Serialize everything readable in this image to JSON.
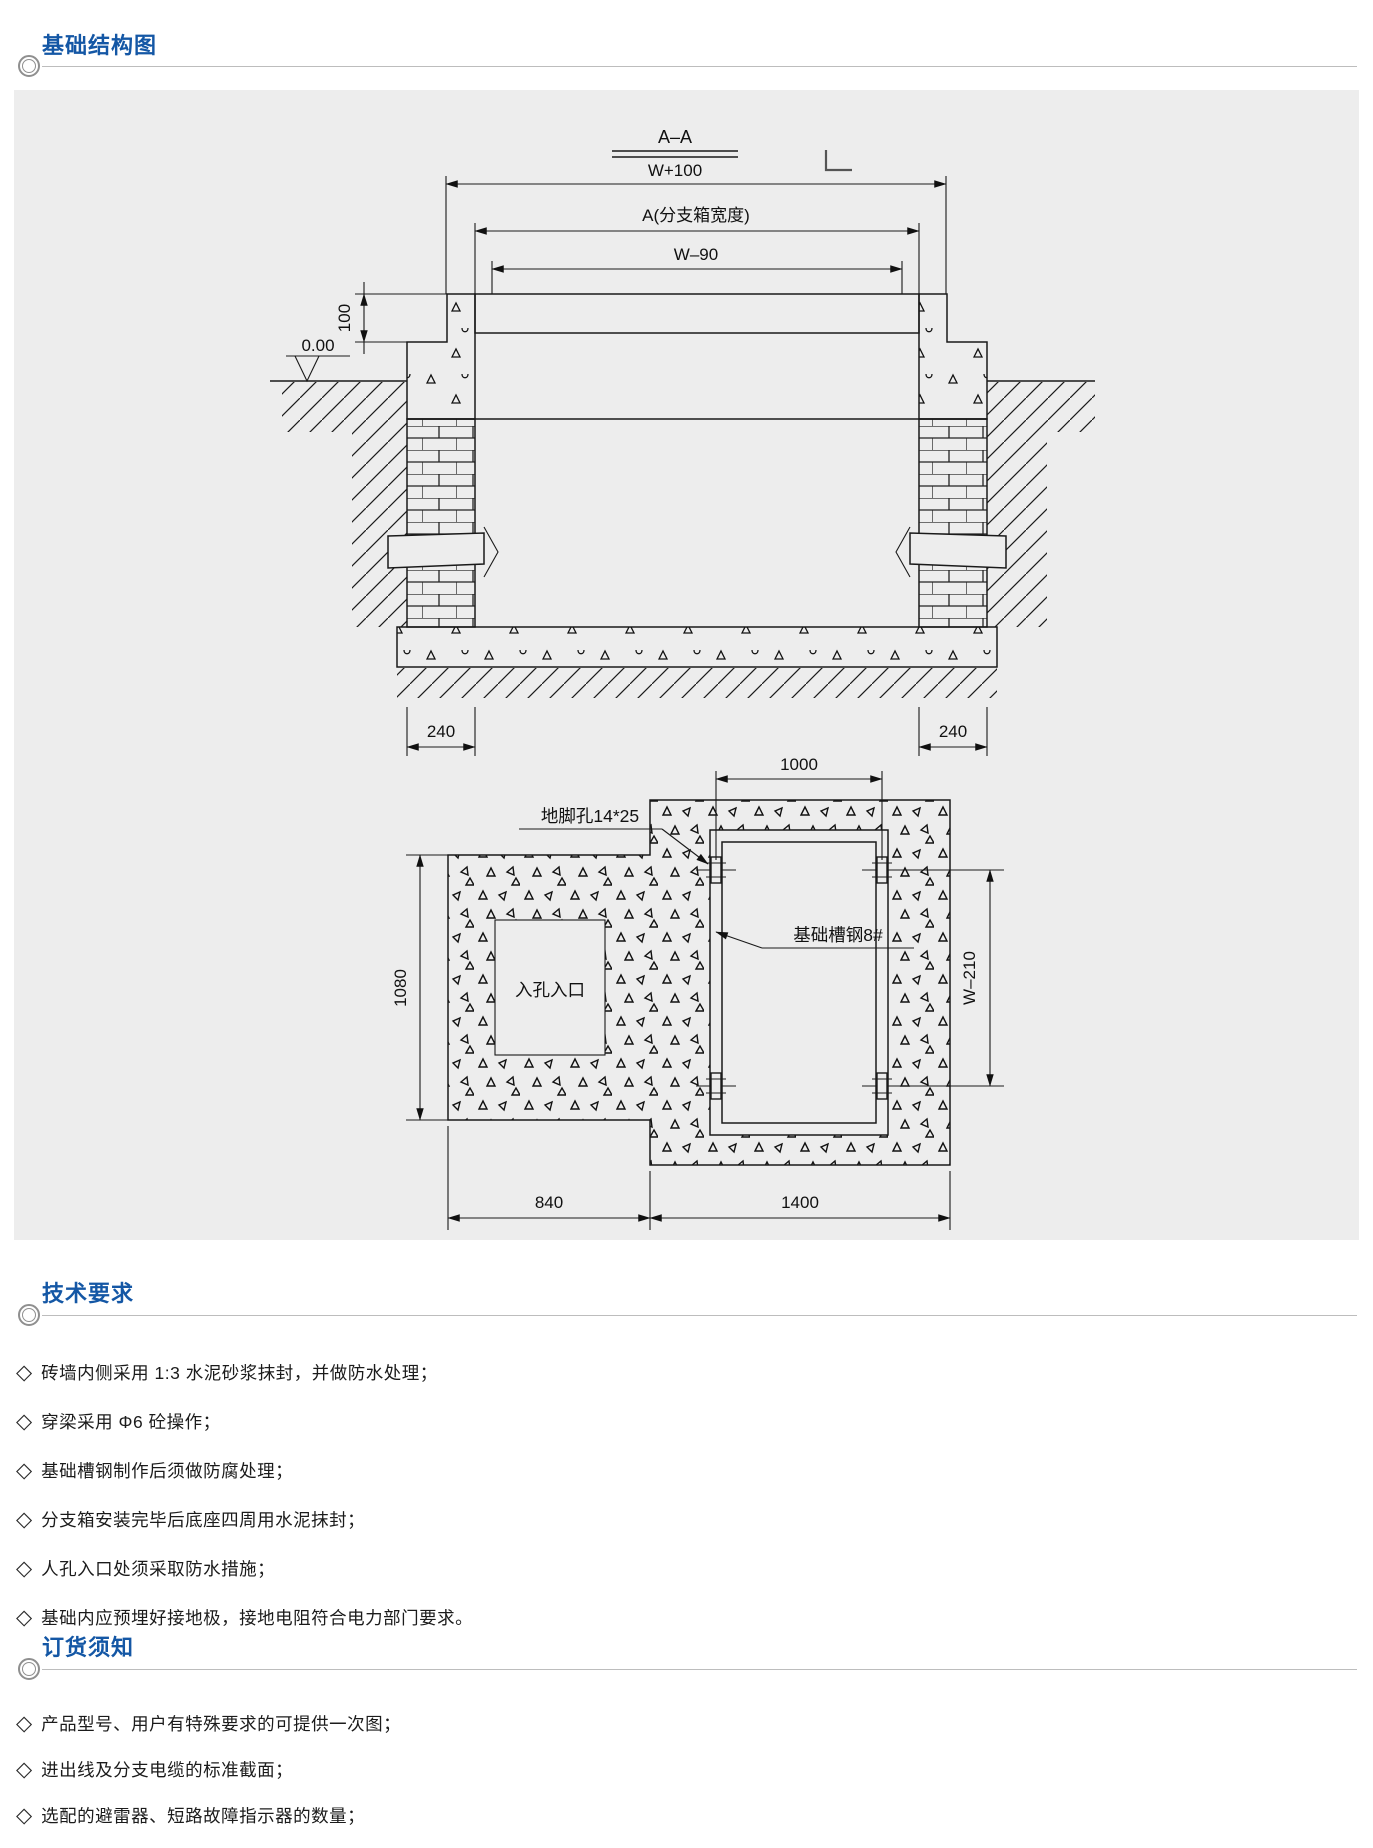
{
  "foundation": {
    "title": "基础结构图"
  },
  "tech": {
    "title": "技术要求",
    "items": [
      "砖墙内侧采用 1:3 水泥砂浆抹封，并做防水处理；",
      "穿梁采用 Φ6 砼操作；",
      "基础槽钢制作后须做防腐处理；",
      "分支箱安装完毕后底座四周用水泥抹封；",
      "人孔入口处须采取防水措施；",
      "基础内应预埋好接地极，接地电阻符合电力部门要求。"
    ]
  },
  "order": {
    "title": "订货须知",
    "items": [
      "产品型号、用户有特殊要求的可提供一次图；",
      "进出线及分支电缆的标准截面；",
      "选配的避雷器、短路故障指示器的数量；"
    ]
  },
  "drawing": {
    "section": {
      "label": "A–A",
      "dim_top": "W+100",
      "dim_box": "A(分支箱宽度)",
      "dim_inner": "W–90",
      "dim_cap": "100",
      "level": "0.00",
      "dim_wall_left": "240",
      "dim_wall_right": "240"
    },
    "plan": {
      "dim_bolt_span": "1000",
      "dim_left_height": "1080",
      "dim_frame_height": "W–210",
      "dim_left_width": "840",
      "dim_right_width": "1400",
      "anchor_hole_label": "地脚孔14*25",
      "channel_label": "基础槽钢8#",
      "manhole_label": "入孔入口"
    }
  },
  "colors": {
    "accent": "#1457a5",
    "panel_bg": "#ededed",
    "line": "#1a1a1a"
  }
}
